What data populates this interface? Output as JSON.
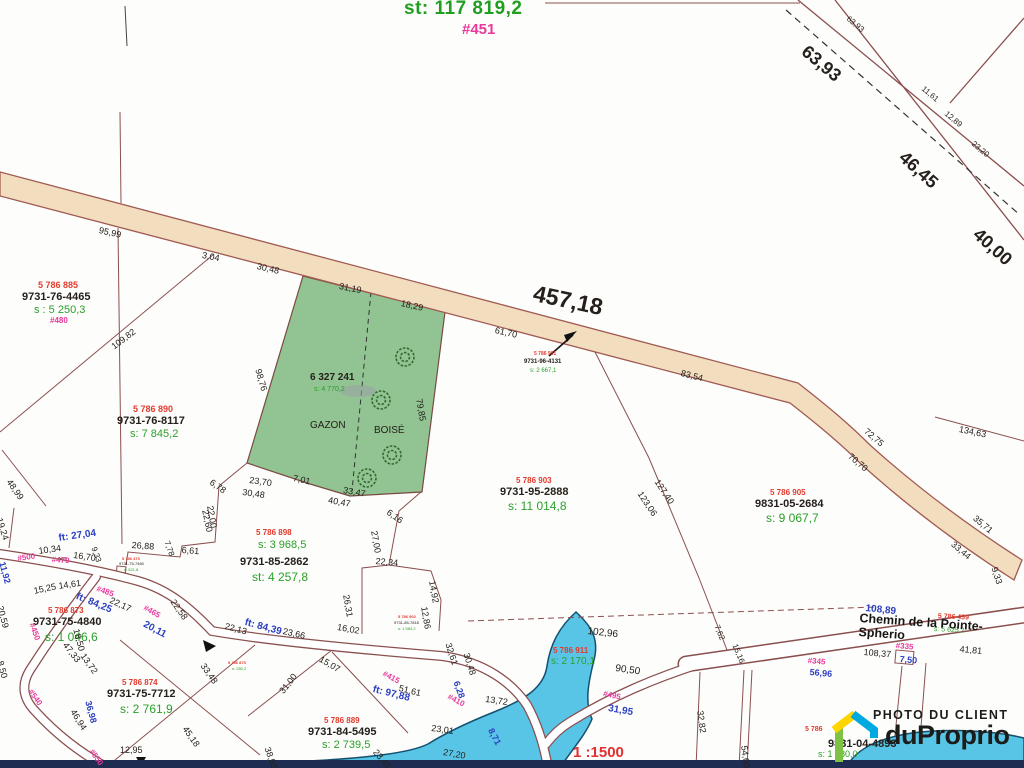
{
  "header": {
    "area_total": "st: 117 819,2",
    "plan_ref": "#451"
  },
  "scale": {
    "text": "1 :1500"
  },
  "street": {
    "name": "Chemin de la Pointe-Spherio"
  },
  "watermark": {
    "tagline": "PHOTO DU CLIENT",
    "brand": "duProprio"
  },
  "colors": {
    "lot-red": "#e23b2e",
    "area-green": "#2aa02a",
    "addr-pink": "#e83a9c",
    "meas-blue": "#2b3fc0",
    "blk": "#25201b",
    "title-green": "#1f9e1f",
    "scale-red": "#e03030",
    "line": "#8a4f4f",
    "road-fill": "#f2debf",
    "grass": "#92c392",
    "water": "#58c5e6",
    "water-line": "#14506e",
    "navy-bar": "#1f2d52",
    "logo-green": "#7dc242",
    "logo-blue": "#00a9e0",
    "logo-yellow": "#ffd500"
  },
  "parcels": [
    {
      "name": "lot-885",
      "lines": [
        {
          "t": "5 786 885",
          "x": 38,
          "y": 281,
          "c": "red",
          "s": 9
        },
        {
          "t": "9731-76-4465",
          "x": 22,
          "y": 292,
          "c": "blk",
          "s": 11,
          "b": 1
        },
        {
          "t": "s : 5 250,3",
          "x": 34,
          "y": 305,
          "c": "grn",
          "s": 11
        },
        {
          "t": "#480",
          "x": 50,
          "y": 317,
          "c": "pnk",
          "s": 8
        }
      ]
    },
    {
      "name": "lot-890",
      "lines": [
        {
          "t": "5 786 890",
          "x": 133,
          "y": 405,
          "c": "red",
          "s": 9
        },
        {
          "t": "9731-76-8117",
          "x": 117,
          "y": 416,
          "c": "blk",
          "s": 11,
          "b": 1
        },
        {
          "t": "s: 7 845,2",
          "x": 130,
          "y": 429,
          "c": "grn",
          "s": 11
        }
      ]
    },
    {
      "name": "lot-6327241",
      "lines": [
        {
          "t": "6 327 241",
          "x": 310,
          "y": 373,
          "c": "blk",
          "s": 10,
          "b": 1
        },
        {
          "t": "s: 4 770,2",
          "x": 314,
          "y": 386,
          "c": "grn",
          "s": 7
        },
        {
          "t": "GAZON",
          "x": 310,
          "y": 421,
          "c": "blk",
          "s": 10
        },
        {
          "t": "BOISÉ",
          "x": 374,
          "y": 426,
          "c": "blk",
          "s": 10
        }
      ]
    },
    {
      "name": "lot-901",
      "lines": [
        {
          "t": "5 786 901",
          "x": 534,
          "y": 352,
          "c": "red",
          "s": 5
        },
        {
          "t": "9731-96-4131",
          "x": 524,
          "y": 359,
          "c": "blk",
          "s": 6,
          "b": 1
        },
        {
          "t": "s: 2 667,1",
          "x": 530,
          "y": 368,
          "c": "grn",
          "s": 6
        }
      ]
    },
    {
      "name": "lot-903",
      "lines": [
        {
          "t": "5 786 903",
          "x": 516,
          "y": 477,
          "c": "red",
          "s": 8
        },
        {
          "t": "9731-95-2888",
          "x": 500,
          "y": 487,
          "c": "blk",
          "s": 11,
          "b": 1
        },
        {
          "t": "s: 11 014,8",
          "x": 508,
          "y": 500,
          "c": "grn",
          "s": 12
        }
      ]
    },
    {
      "name": "lot-905",
      "lines": [
        {
          "t": "5 786 905",
          "x": 770,
          "y": 489,
          "c": "red",
          "s": 8
        },
        {
          "t": "9831-05-2684",
          "x": 755,
          "y": 499,
          "c": "blk",
          "s": 11,
          "b": 1
        },
        {
          "t": "s: 9 067,7",
          "x": 766,
          "y": 512,
          "c": "grn",
          "s": 12
        }
      ]
    },
    {
      "name": "lot-898",
      "lines": [
        {
          "t": "5 786 898",
          "x": 256,
          "y": 529,
          "c": "red",
          "s": 8
        },
        {
          "t": "s: 3 968,5",
          "x": 258,
          "y": 540,
          "c": "grn",
          "s": 11
        },
        {
          "t": "9731-85-2862",
          "x": 240,
          "y": 557,
          "c": "blk",
          "s": 11,
          "b": 1
        },
        {
          "t": "st: 4 257,8",
          "x": 252,
          "y": 571,
          "c": "grn",
          "s": 12
        }
      ]
    },
    {
      "name": "lot-873",
      "lines": [
        {
          "t": "5 786 873",
          "x": 48,
          "y": 607,
          "c": "red",
          "s": 8
        },
        {
          "t": "9731-75-4840",
          "x": 33,
          "y": 617,
          "c": "blk",
          "s": 11,
          "b": 1
        },
        {
          "t": "s: 1 046,6",
          "x": 45,
          "y": 631,
          "c": "grn",
          "s": 12
        }
      ]
    },
    {
      "name": "lot-874",
      "lines": [
        {
          "t": "5 786 874",
          "x": 122,
          "y": 679,
          "c": "red",
          "s": 8
        },
        {
          "t": "9731-75-7712",
          "x": 107,
          "y": 689,
          "c": "blk",
          "s": 11,
          "b": 1
        },
        {
          "t": "s: 2 761,9",
          "x": 120,
          "y": 703,
          "c": "grn",
          "s": 12
        }
      ]
    },
    {
      "name": "lot-889",
      "lines": [
        {
          "t": "5 786 889",
          "x": 324,
          "y": 717,
          "c": "red",
          "s": 8
        },
        {
          "t": "9731-84-5495",
          "x": 308,
          "y": 727,
          "c": "blk",
          "s": 11,
          "b": 1
        },
        {
          "t": "s: 2 739,5",
          "x": 322,
          "y": 740,
          "c": "grn",
          "s": 11
        }
      ]
    },
    {
      "name": "lot-911",
      "lines": [
        {
          "t": "5 786 911",
          "x": 553,
          "y": 647,
          "c": "red",
          "s": 8
        },
        {
          "t": "s: 2 170,1",
          "x": 551,
          "y": 657,
          "c": "grn",
          "s": 10
        }
      ]
    },
    {
      "name": "lot-470",
      "lines": [
        {
          "t": "5 786 470",
          "x": 122,
          "y": 557,
          "c": "red",
          "s": 4
        },
        {
          "t": "9731-75-7460",
          "x": 119,
          "y": 562,
          "c": "blk",
          "s": 4
        },
        {
          "t": "s: 521,8",
          "x": 124,
          "y": 568,
          "c": "grn",
          "s": 4
        }
      ]
    },
    {
      "name": "lot-902",
      "lines": [
        {
          "t": "5 786 902",
          "x": 398,
          "y": 615,
          "c": "red",
          "s": 4
        },
        {
          "t": "9731-85-7818",
          "x": 394,
          "y": 621,
          "c": "blk",
          "s": 4
        },
        {
          "t": "s: 1 583,2",
          "x": 398,
          "y": 627,
          "c": "grn",
          "s": 4
        }
      ]
    },
    {
      "name": "lot-875",
      "lines": [
        {
          "t": "5 786 875",
          "x": 228,
          "y": 661,
          "c": "red",
          "s": 4
        },
        {
          "t": "s: 280,2",
          "x": 232,
          "y": 667,
          "c": "grn",
          "s": 4
        }
      ]
    },
    {
      "name": "lot-459",
      "lines": [
        {
          "t": "5 786 459",
          "x": 938,
          "y": 613,
          "r": 3,
          "c": "red",
          "s": 7
        },
        {
          "t": "s: 5 625,2",
          "x": 934,
          "y": 626,
          "r": 3,
          "c": "grn",
          "s": 7
        }
      ]
    },
    {
      "name": "lot-bottom-right",
      "lines": [
        {
          "t": "5 786",
          "x": 805,
          "y": 726,
          "c": "red",
          "s": 7
        },
        {
          "t": "9831-04-4893",
          "x": 828,
          "y": 739,
          "c": "blk",
          "s": 11,
          "b": 1
        },
        {
          "t": "s: 1 680,0",
          "x": 818,
          "y": 750,
          "c": "grn",
          "s": 9
        }
      ]
    }
  ],
  "measurements": [
    {
      "t": "95,99",
      "x": 100,
      "y": 226,
      "r": 13
    },
    {
      "t": "3,04",
      "x": 203,
      "y": 251,
      "r": 11
    },
    {
      "t": "30,48",
      "x": 258,
      "y": 262,
      "r": 13
    },
    {
      "t": "31,19",
      "x": 340,
      "y": 282,
      "r": 11
    },
    {
      "t": "18,29",
      "x": 402,
      "y": 299,
      "r": 13
    },
    {
      "t": "457,18",
      "x": 536,
      "y": 282,
      "r": 12,
      "s": 23,
      "b": 1
    },
    {
      "t": "61,70",
      "x": 496,
      "y": 326,
      "r": 13
    },
    {
      "t": "83,54",
      "x": 682,
      "y": 369,
      "r": 14
    },
    {
      "t": "72,75",
      "x": 868,
      "y": 427,
      "r": 40
    },
    {
      "t": "70,70",
      "x": 852,
      "y": 452,
      "r": 40
    },
    {
      "t": "134,63",
      "x": 960,
      "y": 425,
      "r": 12
    },
    {
      "t": "35,71",
      "x": 977,
      "y": 514,
      "r": 40
    },
    {
      "t": "33,44",
      "x": 955,
      "y": 540,
      "r": 40
    },
    {
      "t": "9,33",
      "x": 998,
      "y": 566,
      "r": 72
    },
    {
      "t": "63,93",
      "x": 850,
      "y": 15,
      "r": 40,
      "s": 8
    },
    {
      "t": "63,93",
      "x": 810,
      "y": 42,
      "r": 40,
      "s": 18,
      "b": 1
    },
    {
      "t": "11,61",
      "x": 925,
      "y": 85,
      "r": 40,
      "s": 8
    },
    {
      "t": "12,89",
      "x": 948,
      "y": 110,
      "r": 40,
      "s": 8
    },
    {
      "t": "23,20",
      "x": 975,
      "y": 140,
      "r": 40,
      "s": 8
    },
    {
      "t": "46,45",
      "x": 908,
      "y": 148,
      "r": 42,
      "s": 18,
      "b": 1
    },
    {
      "t": "40,00",
      "x": 982,
      "y": 225,
      "r": 42,
      "s": 18,
      "b": 1
    },
    {
      "t": "79,85",
      "x": 423,
      "y": 398,
      "r": 80
    },
    {
      "t": "7,01",
      "x": 294,
      "y": 474,
      "r": 12
    },
    {
      "t": "33,47",
      "x": 344,
      "y": 486,
      "r": 10
    },
    {
      "t": "40,47",
      "x": 329,
      "y": 496,
      "r": 10
    },
    {
      "t": "98,76",
      "x": 262,
      "y": 368,
      "r": 74
    },
    {
      "t": "109,82",
      "x": 110,
      "y": 344,
      "r": -37
    },
    {
      "t": "6,78",
      "x": 213,
      "y": 478,
      "r": 35
    },
    {
      "t": "23,70",
      "x": 250,
      "y": 476,
      "r": 8
    },
    {
      "t": "30,48",
      "x": 243,
      "y": 488,
      "r": 8
    },
    {
      "t": "22,00",
      "x": 214,
      "y": 505,
      "r": 80
    },
    {
      "t": "127,40",
      "x": 660,
      "y": 478,
      "r": 56
    },
    {
      "t": "123,06",
      "x": 643,
      "y": 490,
      "r": 56
    },
    {
      "t": "ft: 27,04",
      "x": 58,
      "y": 534,
      "r": -8,
      "c": "blu",
      "s": 10
    },
    {
      "t": "10,34",
      "x": 38,
      "y": 547,
      "r": -8
    },
    {
      "t": "16,70",
      "x": 74,
      "y": 551,
      "r": 8
    },
    {
      "t": "9,33",
      "x": 97,
      "y": 546,
      "r": 70,
      "s": 8
    },
    {
      "t": "26,88",
      "x": 132,
      "y": 541,
      "r": 4
    },
    {
      "t": "7,78",
      "x": 170,
      "y": 540,
      "r": 70,
      "s": 8
    },
    {
      "t": "6,61",
      "x": 182,
      "y": 546,
      "r": 4
    },
    {
      "t": "22,60",
      "x": 209,
      "y": 509,
      "r": 78
    },
    {
      "t": "#500",
      "x": 17,
      "y": 555,
      "r": -8,
      "c": "pnk",
      "s": 8
    },
    {
      "t": "11,92",
      "x": 6,
      "y": 561,
      "r": 75,
      "c": "blu"
    },
    {
      "t": "#470",
      "x": 52,
      "y": 556,
      "r": 4,
      "c": "pnk",
      "s": 8
    },
    {
      "t": "15,25",
      "x": 33,
      "y": 587,
      "r": -12
    },
    {
      "t": "14,61",
      "x": 58,
      "y": 582,
      "r": -8
    },
    {
      "t": "#485",
      "x": 98,
      "y": 585,
      "r": 20,
      "c": "pnk",
      "s": 8
    },
    {
      "t": "ft: 84,25",
      "x": 78,
      "y": 592,
      "r": 22,
      "c": "blu",
      "s": 10
    },
    {
      "t": "22,17",
      "x": 112,
      "y": 596,
      "r": 25
    },
    {
      "t": "#465",
      "x": 146,
      "y": 604,
      "r": 30,
      "c": "pnk",
      "s": 8
    },
    {
      "t": "22,58",
      "x": 176,
      "y": 598,
      "r": 55
    },
    {
      "t": "20,11",
      "x": 146,
      "y": 620,
      "r": 28,
      "c": "blu",
      "s": 10
    },
    {
      "t": "19,24",
      "x": 3,
      "y": 517,
      "r": 72
    },
    {
      "t": "48,99",
      "x": 12,
      "y": 478,
      "r": 55
    },
    {
      "t": "20,59",
      "x": 4,
      "y": 605,
      "r": 75
    },
    {
      "t": "#450",
      "x": 35,
      "y": 622,
      "r": 70,
      "c": "pnk",
      "s": 8
    },
    {
      "t": "18,50",
      "x": 80,
      "y": 628,
      "r": 75
    },
    {
      "t": "13,72",
      "x": 86,
      "y": 652,
      "r": 55
    },
    {
      "t": "8,50",
      "x": 4,
      "y": 660,
      "r": 75
    },
    {
      "t": "47,33",
      "x": 68,
      "y": 641,
      "r": 52
    },
    {
      "t": "36,98",
      "x": 92,
      "y": 700,
      "r": 75,
      "c": "blu"
    },
    {
      "t": "46,94",
      "x": 76,
      "y": 708,
      "r": 58
    },
    {
      "t": "#540",
      "x": 33,
      "y": 688,
      "r": 55,
      "c": "pnk",
      "s": 8
    },
    {
      "t": "#550",
      "x": 94,
      "y": 748,
      "r": 55,
      "c": "pnk",
      "s": 8
    },
    {
      "t": "12,95",
      "x": 120,
      "y": 746,
      "r": 0
    },
    {
      "t": "22,13",
      "x": 226,
      "y": 622,
      "r": 15
    },
    {
      "t": "ft: 84,39",
      "x": 246,
      "y": 618,
      "r": 15,
      "c": "blu",
      "s": 10
    },
    {
      "t": "23,66",
      "x": 284,
      "y": 627,
      "r": 13
    },
    {
      "t": "16,02",
      "x": 338,
      "y": 623,
      "r": 10
    },
    {
      "t": "15,07",
      "x": 322,
      "y": 655,
      "r": 30
    },
    {
      "t": "26,31",
      "x": 350,
      "y": 594,
      "r": 80
    },
    {
      "t": "27,00",
      "x": 378,
      "y": 530,
      "r": 80
    },
    {
      "t": "6,16",
      "x": 390,
      "y": 508,
      "r": 35
    },
    {
      "t": "22,34",
      "x": 376,
      "y": 557,
      "r": 5
    },
    {
      "t": "14,92",
      "x": 436,
      "y": 580,
      "r": 80
    },
    {
      "t": "12,86",
      "x": 428,
      "y": 606,
      "r": 80
    },
    {
      "t": "33,48",
      "x": 206,
      "y": 662,
      "r": 55
    },
    {
      "t": "45,18",
      "x": 188,
      "y": 725,
      "r": 55
    },
    {
      "t": "31,00",
      "x": 278,
      "y": 690,
      "r": -52
    },
    {
      "t": "38,65",
      "x": 271,
      "y": 746,
      "r": 70
    },
    {
      "t": "ft: 97,88",
      "x": 374,
      "y": 685,
      "r": 14,
      "c": "blu",
      "s": 10
    },
    {
      "t": "51,61",
      "x": 400,
      "y": 684,
      "r": 14
    },
    {
      "t": "23,01",
      "x": 432,
      "y": 724,
      "r": 8
    },
    {
      "t": "23,45",
      "x": 378,
      "y": 748,
      "r": 50
    },
    {
      "t": "27,20",
      "x": 444,
      "y": 748,
      "r": 10
    },
    {
      "t": "13,72",
      "x": 486,
      "y": 695,
      "r": 8
    },
    {
      "t": "8,71",
      "x": 494,
      "y": 727,
      "r": 62,
      "c": "blu"
    },
    {
      "t": "6,28",
      "x": 460,
      "y": 680,
      "r": 70,
      "c": "blu"
    },
    {
      "t": "#415",
      "x": 385,
      "y": 670,
      "r": 28,
      "c": "pnk",
      "s": 8
    },
    {
      "t": "#410",
      "x": 450,
      "y": 693,
      "r": 28,
      "c": "pnk",
      "s": 8
    },
    {
      "t": "32,61",
      "x": 452,
      "y": 642,
      "r": 72
    },
    {
      "t": "30,48",
      "x": 470,
      "y": 652,
      "r": 72
    },
    {
      "t": "102,96",
      "x": 588,
      "y": 627,
      "r": 6,
      "s": 10
    },
    {
      "t": "90,50",
      "x": 616,
      "y": 664,
      "r": 8,
      "s": 10
    },
    {
      "t": "#495",
      "x": 604,
      "y": 690,
      "r": 12,
      "c": "pnk",
      "s": 8
    },
    {
      "t": "31,95",
      "x": 609,
      "y": 704,
      "r": 10,
      "c": "blu",
      "s": 10
    },
    {
      "t": "108,89",
      "x": 866,
      "y": 604,
      "r": 6,
      "c": "blu",
      "s": 10
    },
    {
      "t": "108,37",
      "x": 864,
      "y": 648,
      "r": 5
    },
    {
      "t": "#335",
      "x": 896,
      "y": 642,
      "r": 5,
      "c": "pnk",
      "s": 8
    },
    {
      "t": "7,50",
      "x": 900,
      "y": 655,
      "r": 5,
      "c": "blu"
    },
    {
      "t": "41,81",
      "x": 960,
      "y": 645,
      "r": 5
    },
    {
      "t": "#345",
      "x": 808,
      "y": 657,
      "r": 5,
      "c": "pnk",
      "s": 8
    },
    {
      "t": "56,96",
      "x": 810,
      "y": 668,
      "r": 5,
      "c": "blu"
    },
    {
      "t": "7,62",
      "x": 720,
      "y": 624,
      "r": 68,
      "s": 8
    },
    {
      "t": "15,16",
      "x": 738,
      "y": 643,
      "r": 68,
      "s": 8
    },
    {
      "t": "32,82",
      "x": 704,
      "y": 710,
      "r": 82
    },
    {
      "t": "54,60",
      "x": 748,
      "y": 745,
      "r": 82
    }
  ]
}
